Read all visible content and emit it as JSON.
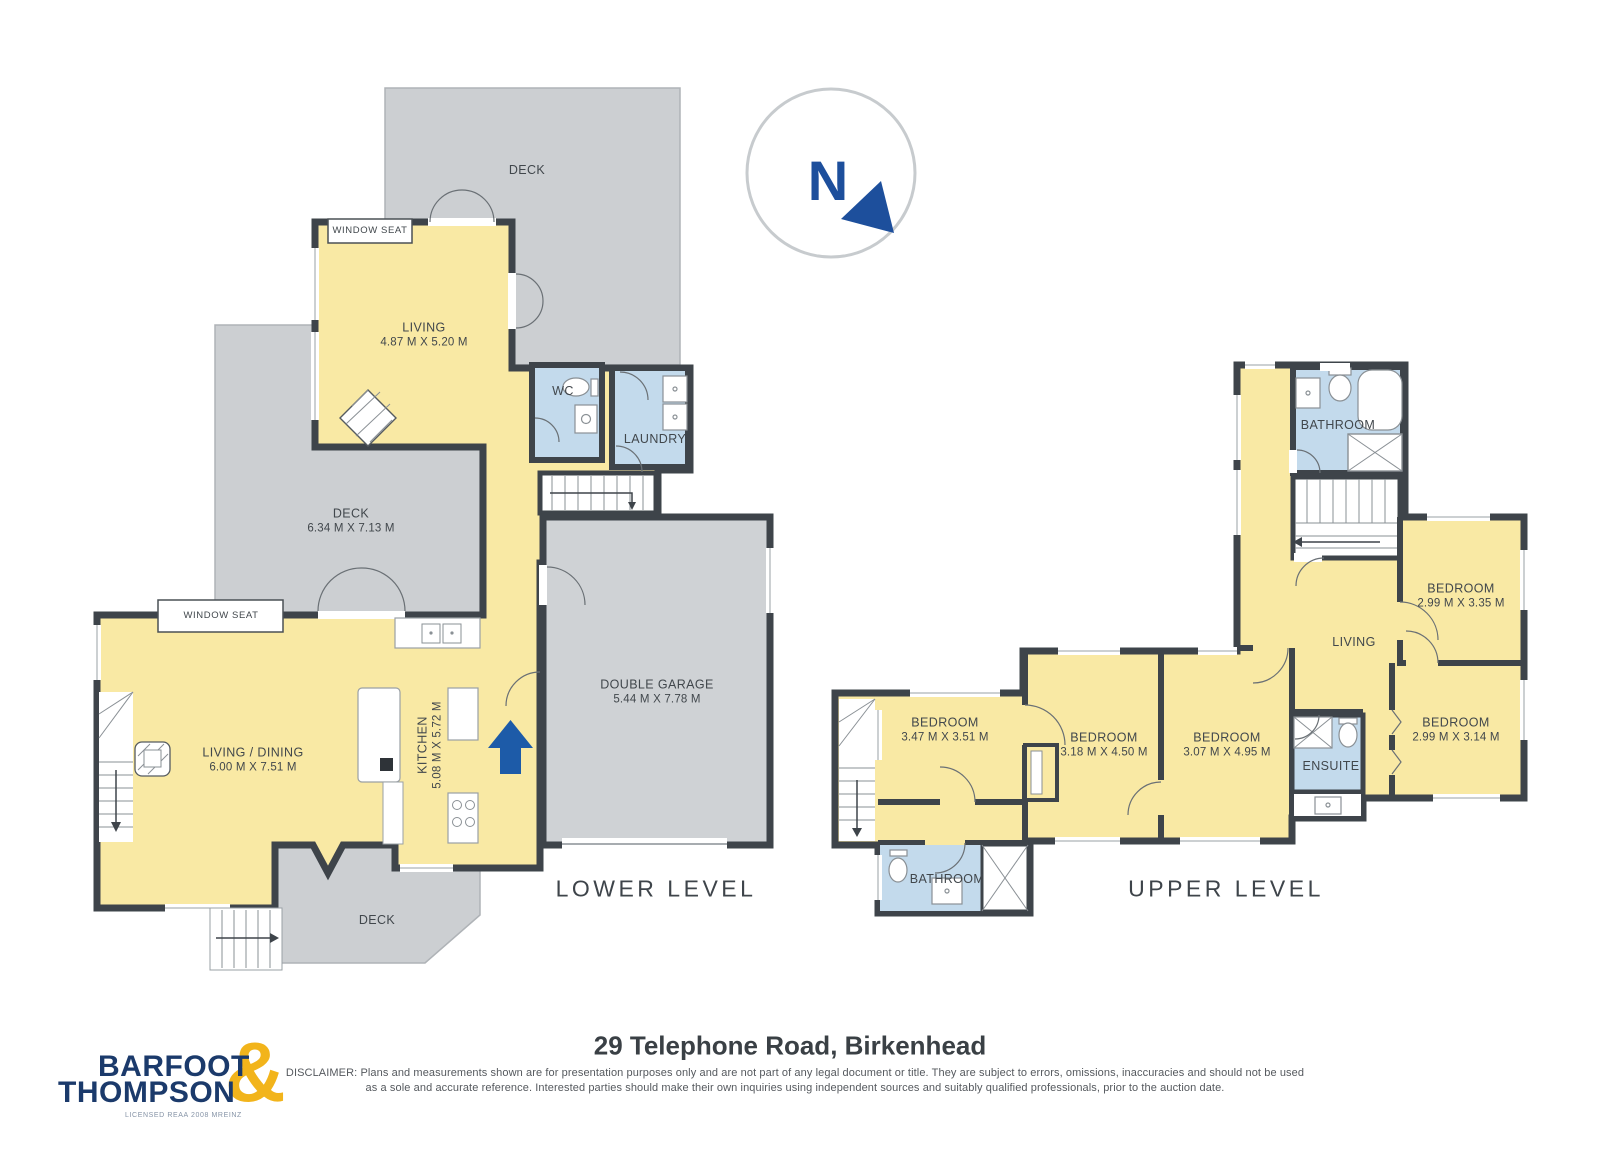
{
  "page": {
    "width": 1600,
    "height": 1167
  },
  "palette": {
    "wall": "#3E444A",
    "floor_yellow": "#F9E9A4",
    "deck_gray": "#CCCFD2",
    "wet_blue": "#C3DAEC",
    "fixture_line": "#8A9095",
    "text": "#41474C",
    "entry_arrow_blue": "#1D5BA8",
    "compass_blue": "#1D4F9C",
    "compass_ring_gray": "#C7CBCE"
  },
  "compass": {
    "letter": "N"
  },
  "lower": {
    "title": "LOWER LEVEL",
    "rooms": {
      "deck_top": {
        "label": "DECK"
      },
      "window_seat_top": {
        "label": "WINDOW SEAT"
      },
      "living": {
        "label": "LIVING",
        "dims": "4.87 M X 5.20 M"
      },
      "wc": {
        "label": "WC"
      },
      "laundry": {
        "label": "LAUNDRY"
      },
      "deck_mid": {
        "label": "DECK",
        "dims": "6.34 M X 7.13 M"
      },
      "window_seat_left": {
        "label": "WINDOW SEAT"
      },
      "living_dining": {
        "label": "LIVING / DINING",
        "dims": "6.00 M X 7.51 M"
      },
      "kitchen": {
        "label": "KITCHEN",
        "dims": "5.08 M X 5.72 M"
      },
      "garage": {
        "label": "DOUBLE GARAGE",
        "dims": "5.44 M X 7.78 M"
      },
      "deck_bottom": {
        "label": "DECK"
      }
    }
  },
  "upper": {
    "title": "UPPER LEVEL",
    "rooms": {
      "bathroom_top": {
        "label": "BATHROOM"
      },
      "bedroom_ne": {
        "label": "BEDROOM",
        "dims": "2.99 M X 3.35 M"
      },
      "living": {
        "label": "LIVING"
      },
      "bedroom_e": {
        "label": "BEDROOM",
        "dims": "2.99 M X 3.14 M"
      },
      "ensuite": {
        "label": "ENSUITE"
      },
      "bedroom_c": {
        "label": "BEDROOM",
        "dims": "3.07 M X 4.95 M"
      },
      "bedroom_c2": {
        "label": "BEDROOM",
        "dims": "3.18 M X 4.50 M"
      },
      "bedroom_w": {
        "label": "BEDROOM",
        "dims": "3.47 M X 3.51 M"
      },
      "bathroom_bottom": {
        "label": "BATHROOM"
      }
    }
  },
  "footer": {
    "address_title": "29 Telephone Road, Birkenhead",
    "disclaimer_line1": "DISCLAIMER: Plans and measurements shown are for presentation purposes only and are not part of any legal document or title. They are subject to errors, omissions, inaccuracies and should not be used",
    "disclaimer_line2": "as a sole and accurate reference. Interested parties should make their own inquiries using independent sources and suitably qualified professionals, prior to the auction date.",
    "brand": {
      "line1": "BARFOOT",
      "line2": "THOMPSON",
      "ampersand": "&",
      "tagline": "LICENSED REAA 2008 MREINZ"
    }
  }
}
